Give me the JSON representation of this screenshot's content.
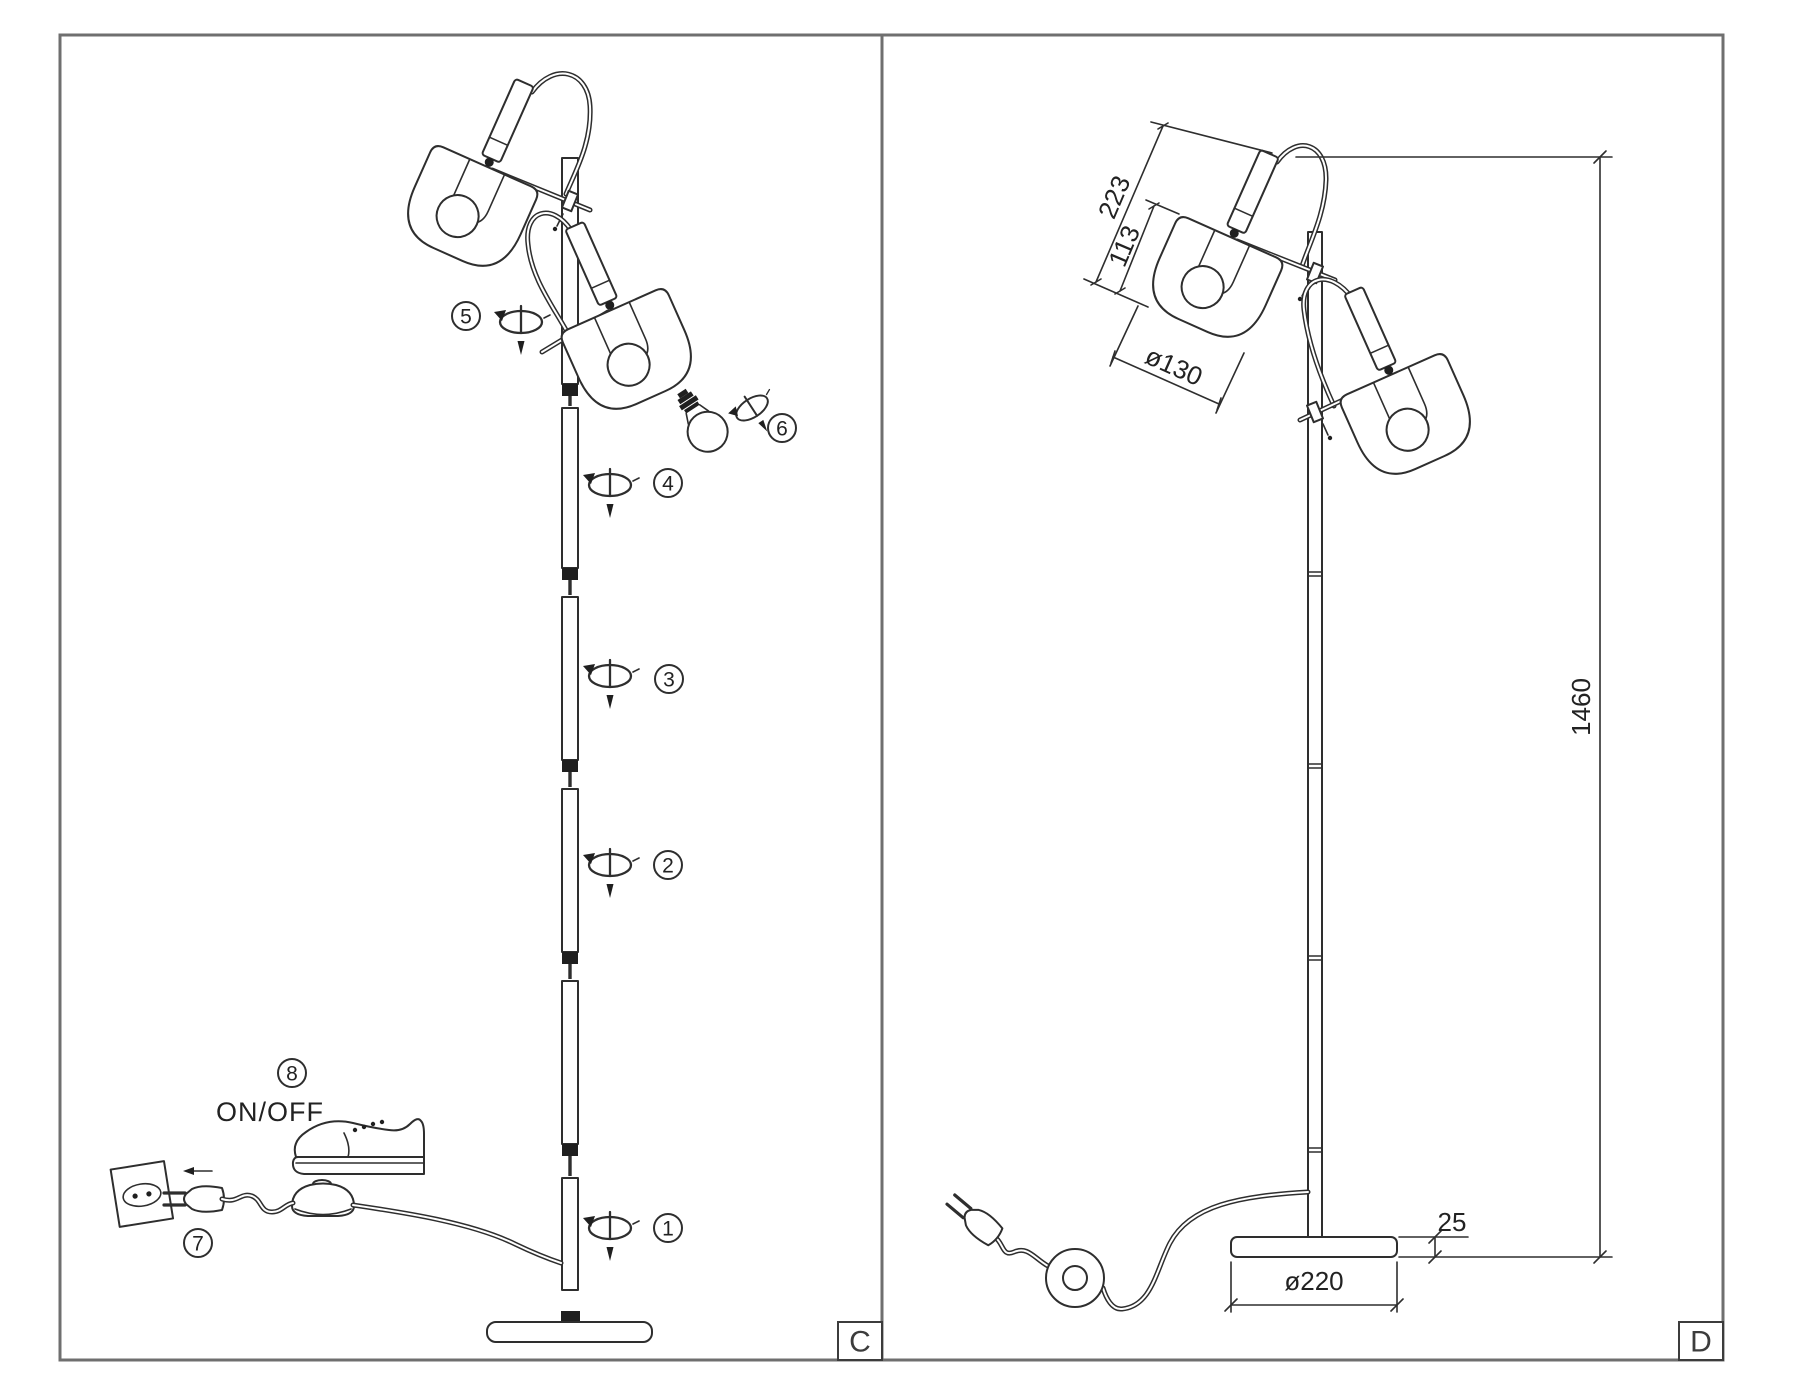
{
  "panels": {
    "c": {
      "label": "C",
      "power_label": "ON/OFF",
      "steps": [
        "1",
        "2",
        "3",
        "4",
        "5",
        "6",
        "7",
        "8"
      ]
    },
    "d": {
      "label": "D",
      "dimensions": {
        "head_length": "223",
        "shade_height": "113",
        "shade_diameter": "ø130",
        "lamp_height": "1460",
        "base_height": "25",
        "base_diameter": "ø220"
      }
    }
  },
  "icons": [
    "screw-rotate-icon",
    "bulb-icon",
    "plug-icon",
    "outlet-icon",
    "foot-switch-icon",
    "shoe-icon"
  ],
  "colors": {
    "line": "#2e2e2e",
    "frame": "#6f6f6f",
    "text": "#222222"
  }
}
